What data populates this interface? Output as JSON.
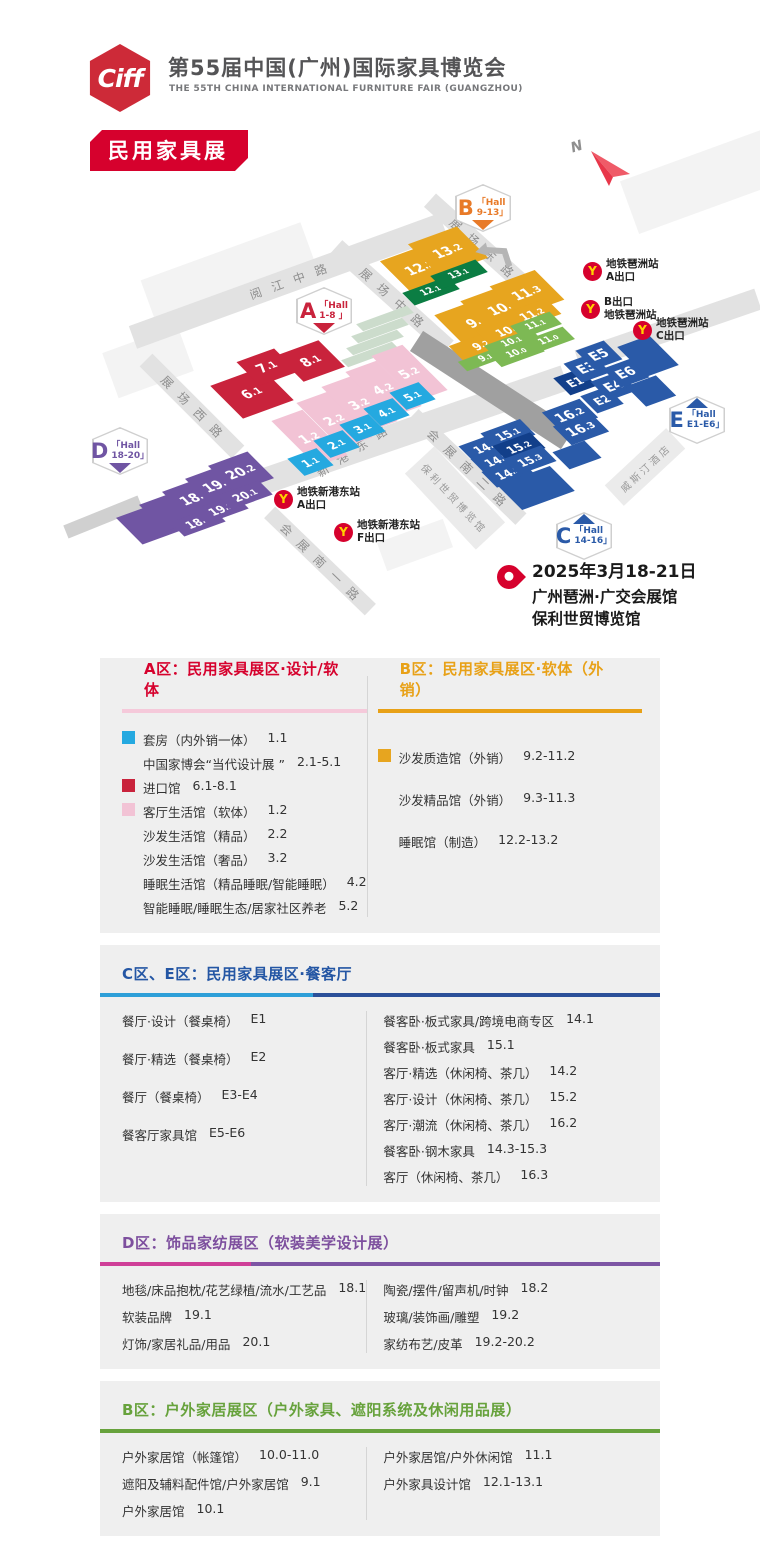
{
  "header": {
    "logo": "Ciff",
    "title_cn": "第55届中国(广州)国际家具博览会",
    "title_en": "THE 55TH CHINA INTERNATIONAL FURNITURE FAIR (GUANGZHOU)",
    "badge": "民用家具展"
  },
  "palette": {
    "red": "#c9233c",
    "pink": "#f2c3d5",
    "cyan": "#25a9e0",
    "purple": "#7055a3",
    "yellow": "#e7a51f",
    "dgreen": "#0b7d43",
    "lgreen": "#7db954",
    "blue": "#2a5aa8",
    "navy": "#123f8a",
    "grey_dark_road": "#a0a0a0",
    "metro_red": "#d6012d",
    "metro_yellow": "#ffd200"
  },
  "map": {
    "compass": "N",
    "location": {
      "date": "2025年3月18-21日",
      "venue1": "广州琶洲·广交会展馆",
      "venue2": "保利世贸博览馆"
    },
    "bg_blocks": [
      {
        "x": 228,
        "y": 272,
        "w": 170,
        "h": 44,
        "a": -20
      },
      {
        "x": 148,
        "y": 362,
        "w": 80,
        "h": 48,
        "a": -20
      },
      {
        "x": 700,
        "y": 182,
        "w": 150,
        "h": 56,
        "a": -20
      },
      {
        "x": 415,
        "y": 545,
        "w": 70,
        "h": 30,
        "a": -20
      }
    ],
    "roads": [
      {
        "label": "阅江中路",
        "x": 288,
        "y": 281,
        "len": 330,
        "t": 24,
        "a": -20
      },
      {
        "label": "展场西路",
        "x": 192,
        "y": 406,
        "len": 130,
        "t": 18,
        "a": 45
      },
      {
        "label": "展场中路",
        "x": 392,
        "y": 297,
        "len": 150,
        "t": 18,
        "a": 42
      },
      {
        "label": "展场东路",
        "x": 482,
        "y": 247,
        "len": 140,
        "t": 18,
        "a": 42
      },
      {
        "label": "新港东路",
        "x": 352,
        "y": 451,
        "len": 450,
        "t": 26,
        "a": -19,
        "extra": -14
      },
      {
        "label": "",
        "x": 668,
        "y": 330,
        "len": 190,
        "t": 22,
        "a": -19
      },
      {
        "label": "会展南一路",
        "x": 320,
        "y": 561,
        "len": 140,
        "t": 16,
        "a": 44
      },
      {
        "label": "会展南二路",
        "x": 467,
        "y": 467,
        "len": 150,
        "t": 16,
        "a": 44
      },
      {
        "label": "",
        "x": 492,
        "y": 390,
        "len": 180,
        "t": 24,
        "a": 33,
        "c": "#a0a0a0"
      },
      {
        "label": "",
        "x": 103,
        "y": 517,
        "len": 80,
        "t": 14,
        "a": -22,
        "c": "#d0d0d0"
      }
    ],
    "steps": [
      {
        "x": 385,
        "y": 318
      },
      {
        "x": 380,
        "y": 330
      },
      {
        "x": 375,
        "y": 342
      },
      {
        "x": 370,
        "y": 354
      }
    ],
    "buildings": [
      {
        "label": "保利世贸博览馆",
        "x": 455,
        "y": 498,
        "w": 104,
        "h": 40,
        "a": 47
      },
      {
        "label": "威斯汀酒店",
        "x": 645,
        "y": 467,
        "w": 84,
        "h": 28,
        "a": -43
      }
    ],
    "halls": [
      {
        "label": "6.1",
        "x": 252,
        "y": 393,
        "w": 54,
        "h": 42,
        "c": "red"
      },
      {
        "label": "7.1",
        "x": 267,
        "y": 367,
        "w": 40,
        "h": 30,
        "c": "red"
      },
      {
        "label": "8.1",
        "x": 311,
        "y": 361,
        "w": 44,
        "h": 34,
        "c": "red"
      },
      {
        "label": "1.2",
        "x": 309,
        "y": 438,
        "w": 33,
        "h": 58,
        "c": "pink"
      },
      {
        "label": "2.2",
        "x": 334,
        "y": 420,
        "w": 33,
        "h": 58,
        "c": "pink"
      },
      {
        "label": "3.2",
        "x": 359,
        "y": 404,
        "w": 33,
        "h": 58,
        "c": "pink"
      },
      {
        "label": "4.2",
        "x": 383,
        "y": 389,
        "w": 33,
        "h": 58,
        "c": "pink"
      },
      {
        "label": "5.2",
        "x": 409,
        "y": 373,
        "w": 33,
        "h": 58,
        "c": "pink"
      },
      {
        "label": "1.1",
        "x": 310,
        "y": 462,
        "w": 31,
        "h": 22,
        "c": "cyan"
      },
      {
        "label": "2.1",
        "x": 336,
        "y": 444,
        "w": 31,
        "h": 22,
        "c": "cyan"
      },
      {
        "label": "3.1",
        "x": 362,
        "y": 428,
        "w": 31,
        "h": 22,
        "c": "cyan"
      },
      {
        "label": "4.1",
        "x": 386,
        "y": 412,
        "w": 31,
        "h": 22,
        "c": "cyan"
      },
      {
        "label": "5.1",
        "x": 412,
        "y": 396,
        "w": 31,
        "h": 22,
        "c": "cyan"
      },
      {
        "label": "",
        "x": 149,
        "y": 524,
        "w": 42,
        "h": 34,
        "c": "purple"
      },
      {
        "label": "",
        "x": 172,
        "y": 511,
        "w": 42,
        "h": 34,
        "c": "purple"
      },
      {
        "label": "18.2",
        "x": 195,
        "y": 498,
        "w": 42,
        "h": 34,
        "c": "purple"
      },
      {
        "label": "19.2",
        "x": 218,
        "y": 485,
        "w": 42,
        "h": 34,
        "c": "purple"
      },
      {
        "label": "20.2",
        "x": 241,
        "y": 472,
        "w": 42,
        "h": 34,
        "c": "purple"
      },
      {
        "label": "18.1",
        "x": 198,
        "y": 522,
        "w": 44,
        "h": 18,
        "c": "purple"
      },
      {
        "label": "19.1",
        "x": 221,
        "y": 509,
        "w": 44,
        "h": 18,
        "c": "purple"
      },
      {
        "label": "20.1",
        "x": 245,
        "y": 495,
        "w": 44,
        "h": 18,
        "c": "purple"
      },
      {
        "label": "12.2",
        "x": 420,
        "y": 268,
        "w": 52,
        "h": 40,
        "c": "yellow"
      },
      {
        "label": "13.2",
        "x": 448,
        "y": 251,
        "w": 52,
        "h": 40,
        "c": "yellow"
      },
      {
        "label": "12.1",
        "x": 431,
        "y": 291,
        "w": 48,
        "h": 16,
        "c": "dgreen"
      },
      {
        "label": "13.1",
        "x": 459,
        "y": 274,
        "w": 48,
        "h": 16,
        "c": "dgreen"
      },
      {
        "label": "9.3",
        "x": 477,
        "y": 322,
        "w": 56,
        "h": 42,
        "c": "yellow"
      },
      {
        "label": "10.3",
        "x": 503,
        "y": 308,
        "w": 56,
        "h": 42,
        "c": "yellow"
      },
      {
        "label": "11.3",
        "x": 527,
        "y": 293,
        "w": 48,
        "h": 38,
        "c": "yellow"
      },
      {
        "label": "9.2",
        "x": 481,
        "y": 345,
        "w": 52,
        "h": 20,
        "c": "yellow"
      },
      {
        "label": "10.2",
        "x": 508,
        "y": 330,
        "w": 52,
        "h": 20,
        "c": "yellow"
      },
      {
        "label": "11.2",
        "x": 532,
        "y": 314,
        "w": 46,
        "h": 20,
        "c": "yellow"
      },
      {
        "label": "9.1",
        "x": 486,
        "y": 358,
        "w": 50,
        "h": 12,
        "c": "lgreen"
      },
      {
        "label": "10.1",
        "x": 512,
        "y": 342,
        "w": 50,
        "h": 12,
        "c": "lgreen"
      },
      {
        "label": "11.1",
        "x": 536,
        "y": 325,
        "w": 42,
        "h": 16,
        "c": "lgreen"
      },
      {
        "label": "10.0",
        "x": 517,
        "y": 353,
        "w": 46,
        "h": 16,
        "c": "lgreen"
      },
      {
        "label": "11.0",
        "x": 549,
        "y": 340,
        "w": 42,
        "h": 16,
        "c": "lgreen"
      },
      {
        "label": "E1",
        "x": 575,
        "y": 382,
        "w": 28,
        "h": 22,
        "c": "navy"
      },
      {
        "label": "E3",
        "x": 587,
        "y": 368,
        "w": 30,
        "h": 24,
        "c": "blue"
      },
      {
        "label": "E5",
        "x": 599,
        "y": 355,
        "w": 30,
        "h": 24,
        "c": "blue"
      },
      {
        "label": "E2",
        "x": 602,
        "y": 400,
        "w": 28,
        "h": 22,
        "c": "blue"
      },
      {
        "label": "E4",
        "x": 614,
        "y": 386,
        "w": 30,
        "h": 24,
        "c": "blue"
      },
      {
        "label": "E6",
        "x": 626,
        "y": 373,
        "w": 30,
        "h": 24,
        "c": "blue"
      },
      {
        "label": "",
        "x": 648,
        "y": 356,
        "w": 34,
        "h": 38,
        "c": "blue"
      },
      {
        "label": "",
        "x": 651,
        "y": 391,
        "w": 32,
        "h": 26,
        "c": "blue"
      },
      {
        "label": "14.1",
        "x": 486,
        "y": 447,
        "w": 42,
        "h": 20,
        "c": "blue"
      },
      {
        "label": "15.1",
        "x": 508,
        "y": 434,
        "w": 42,
        "h": 20,
        "c": "blue"
      },
      {
        "label": "14.2",
        "x": 497,
        "y": 460,
        "w": 40,
        "h": 20,
        "c": "blue"
      },
      {
        "label": "15.2",
        "x": 519,
        "y": 447,
        "w": 40,
        "h": 20,
        "c": "navy"
      },
      {
        "label": "14.3",
        "x": 508,
        "y": 473,
        "w": 40,
        "h": 20,
        "c": "blue"
      },
      {
        "label": "15.3",
        "x": 530,
        "y": 460,
        "w": 40,
        "h": 20,
        "c": "blue"
      },
      {
        "label": "16.2",
        "x": 570,
        "y": 415,
        "w": 40,
        "h": 24,
        "c": "blue"
      },
      {
        "label": "16.3",
        "x": 581,
        "y": 429,
        "w": 40,
        "h": 24,
        "c": "blue"
      },
      {
        "label": "",
        "x": 536,
        "y": 488,
        "w": 56,
        "h": 32,
        "c": "blue"
      },
      {
        "label": "",
        "x": 577,
        "y": 455,
        "w": 34,
        "h": 22,
        "c": "blue"
      }
    ],
    "hall_badges": [
      {
        "letter": "A",
        "l1": "「Hall",
        "l2": "1-8 」",
        "color": "#c9233c",
        "x": 296,
        "y": 287,
        "wedge": "bottom"
      },
      {
        "letter": "B",
        "l1": "「Hall",
        "l2": "9-13」",
        "color": "#e87a28",
        "x": 455,
        "y": 184,
        "wedge": "bottom"
      },
      {
        "letter": "C",
        "l1": "「Hall",
        "l2": "14-16」",
        "color": "#2a5aa8",
        "x": 556,
        "y": 512,
        "wedge": "top"
      },
      {
        "letter": "D",
        "l1": "「Hall",
        "l2": "18-20」",
        "color": "#7055a3",
        "x": 92,
        "y": 427,
        "wedge": "bottom"
      },
      {
        "letter": "E",
        "l1": "「Hall",
        "l2": "E1-E6」",
        "color": "#2a5aa8",
        "x": 669,
        "y": 396,
        "wedge": "top"
      }
    ],
    "metros": [
      {
        "x": 583,
        "y": 258,
        "lines": [
          "地铁琶洲站",
          "A出口"
        ]
      },
      {
        "x": 581,
        "y": 296,
        "lines": [
          "B出口",
          "地铁琶洲站"
        ]
      },
      {
        "x": 633,
        "y": 317,
        "lines": [
          "地铁琶洲站",
          "C出口"
        ]
      },
      {
        "x": 274,
        "y": 486,
        "lines": [
          "地铁新港东站",
          "A出口"
        ]
      },
      {
        "x": 334,
        "y": 519,
        "lines": [
          "地铁新港东站",
          "F出口"
        ]
      }
    ]
  },
  "sections": [
    {
      "id": "ab",
      "cols": [
        {
          "header": {
            "text": "A区：民用家具展区·设计/软体",
            "color": "#d6012d"
          },
          "underline": [
            {
              "c": "#f5c9da",
              "w": "100%"
            }
          ],
          "items": [
            {
              "sw": "#25a9e0",
              "text": "套房（内外销一体）",
              "code": "1.1"
            },
            {
              "ind": true,
              "text": "中国家博会“当代设计展 ”",
              "code": "2.1-5.1"
            },
            {
              "sw": "#c9233c",
              "text": "进口馆",
              "code": "6.1-8.1"
            },
            {
              "sw": "#f2c3d5",
              "text": "客厅生活馆（软体）",
              "code": "1.2"
            },
            {
              "ind": true,
              "text": "沙发生活馆（精品）",
              "code": "2.2"
            },
            {
              "ind": true,
              "text": "沙发生活馆（奢品）",
              "code": "3.2"
            },
            {
              "ind": true,
              "text": "睡眠生活馆（精品睡眠/智能睡眠）",
              "code": "4.2"
            },
            {
              "ind": true,
              "text": "智能睡眠/睡眠生态/居家社区养老",
              "code": "5.2"
            }
          ]
        },
        {
          "header": {
            "text": "B区：民用家具展区·软体（外销）",
            "color": "#e8a117"
          },
          "underline": [
            {
              "c": "#e8a117",
              "w": "100%"
            }
          ],
          "items": [
            {
              "sw": "#e7a51f",
              "text": "沙发质造馆（外销）",
              "code": "9.2-11.2"
            },
            {
              "ind": true,
              "text": "沙发精品馆（外销）",
              "code": "9.3-11.3"
            },
            {
              "ind": true,
              "text": "睡眠馆（制造）",
              "code": "12.2-13.2"
            }
          ]
        }
      ]
    },
    {
      "id": "ce",
      "header": {
        "text": "C区、E区：民用家具展区·餐客厅",
        "color": "#2456a4"
      },
      "underline": [
        {
          "c": "#2e9fd8",
          "w": "38%"
        },
        {
          "c": "#2b5099",
          "w": "62%"
        }
      ],
      "cols": [
        {
          "items": [
            {
              "text": "餐厅·设计（餐桌椅）",
              "code": "E1"
            },
            {
              "text": "餐厅·精选（餐桌椅）",
              "code": "E2"
            },
            {
              "text": "餐厅（餐桌椅）",
              "code": "E3-E4"
            },
            {
              "text": "餐客厅家具馆",
              "code": "E5-E6"
            }
          ]
        },
        {
          "items": [
            {
              "text": "餐客卧·板式家具/跨境电商专区",
              "code": "14.1"
            },
            {
              "text": "餐客卧·板式家具",
              "code": "15.1"
            },
            {
              "text": "客厅·精选（休闲椅、茶几）",
              "code": "14.2"
            },
            {
              "text": "客厅·设计（休闲椅、茶几）",
              "code": "15.2"
            },
            {
              "text": "客厅·潮流（休闲椅、茶几）",
              "code": "16.2"
            },
            {
              "text": "餐客卧·钢木家具",
              "code": "14.3-15.3"
            },
            {
              "text": "客厅（休闲椅、茶几）",
              "code": "16.3"
            }
          ]
        }
      ]
    },
    {
      "id": "d",
      "header": {
        "text": "D区：饰品家纺展区（软装美学设计展）",
        "color": "#7d4f9e"
      },
      "underline": [
        {
          "c": "#cf3f98",
          "w": "27%"
        },
        {
          "c": "#7d55a4",
          "w": "73%"
        }
      ],
      "cols": [
        {
          "items": [
            {
              "text": "地毯/床品抱枕/花艺绿植/流水/工艺品",
              "code": "18.1"
            },
            {
              "text": "软装品牌",
              "code": "19.1"
            },
            {
              "text": "灯饰/家居礼品/用品",
              "code": "20.1"
            }
          ]
        },
        {
          "items": [
            {
              "text": "陶瓷/摆件/留声机/时钟",
              "code": "18.2"
            },
            {
              "text": "玻璃/装饰画/雕塑",
              "code": "19.2"
            },
            {
              "text": "家纺布艺/皮革",
              "code": "19.2-20.2"
            }
          ]
        }
      ]
    },
    {
      "id": "out",
      "header": {
        "text": "B区：户外家居展区（户外家具、遮阳系统及休闲用品展）",
        "color": "#67a23c"
      },
      "underline": [
        {
          "c": "#67a23c",
          "w": "100%"
        }
      ],
      "cols": [
        {
          "items": [
            {
              "text": "户外家居馆（帐篷馆）",
              "code": "10.0-11.0"
            },
            {
              "text": "遮阳及辅料配件馆/户外家居馆",
              "code": "9.1"
            },
            {
              "text": "户外家居馆",
              "code": "10.1"
            }
          ]
        },
        {
          "items": [
            {
              "text": "户外家居馆/户外休闲馆",
              "code": "11.1"
            },
            {
              "text": "户外家具设计馆",
              "code": "12.1-13.1"
            }
          ]
        }
      ]
    }
  ]
}
